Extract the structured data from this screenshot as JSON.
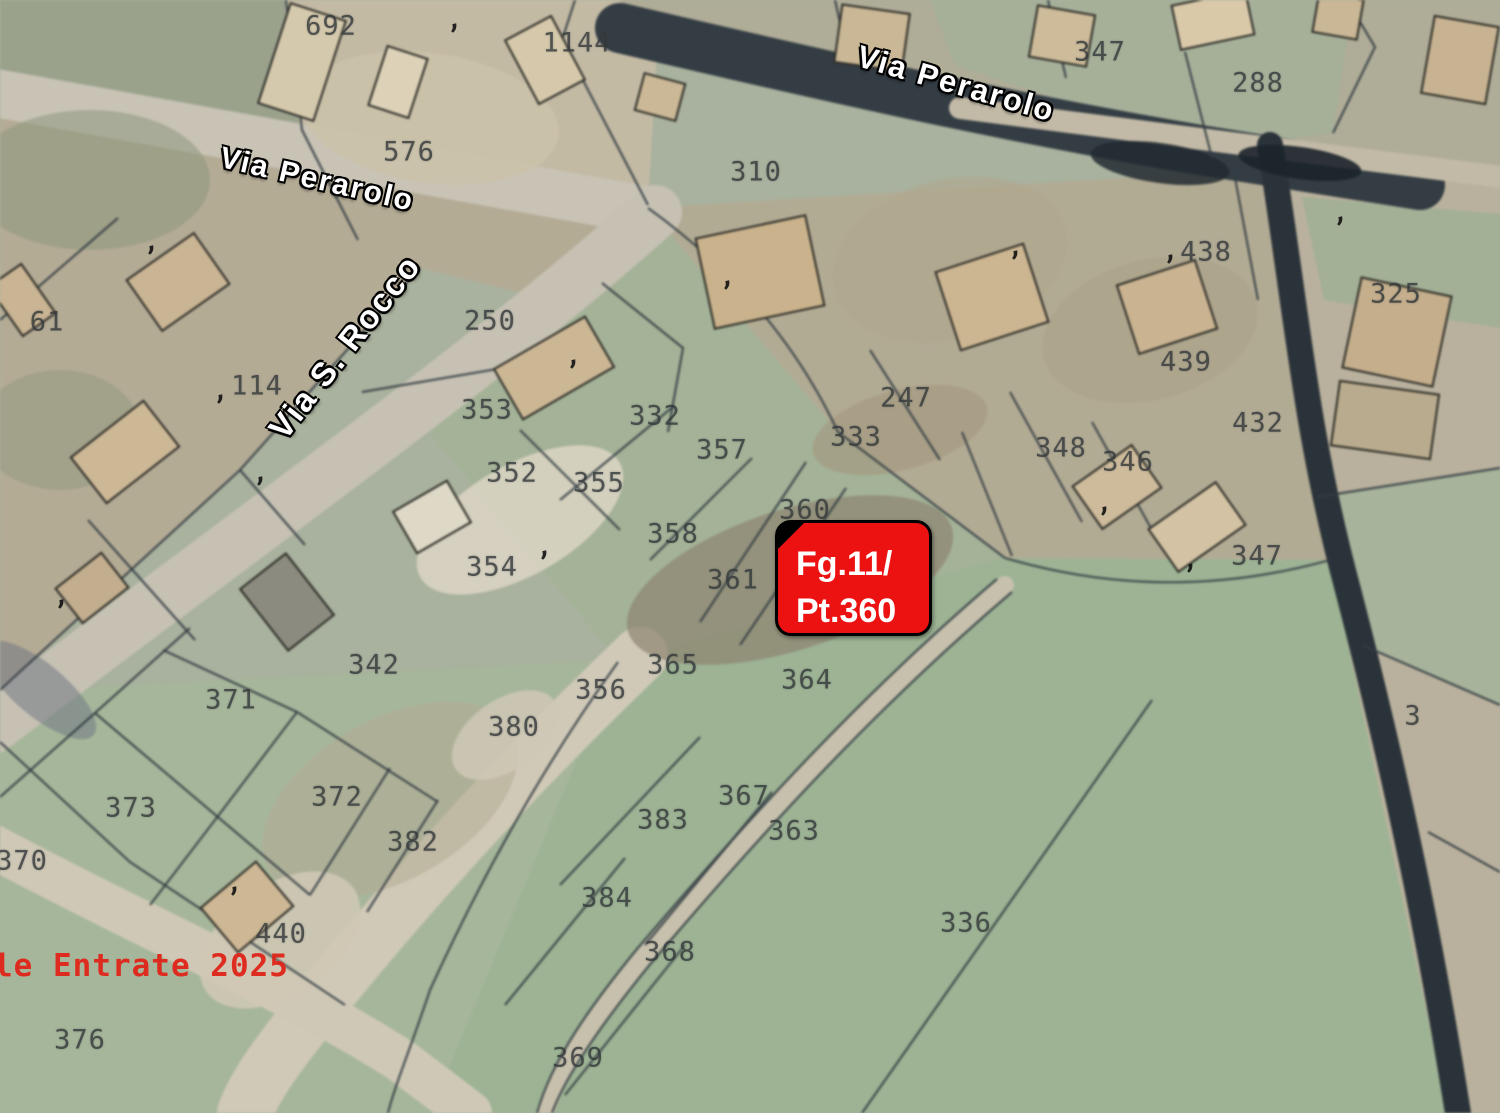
{
  "map": {
    "background_color": "#a9b29e",
    "boundary_color": "#333c43",
    "building_outline_color": "#2e2e28",
    "parcel_number_color": "#33383a",
    "street_label_color": "#ffffff",
    "annotation_box": {
      "line1": "Fg.11/",
      "line2": "Pt.360",
      "x": 775,
      "y": 520,
      "width": 157,
      "height": 116,
      "fill": "#ec1212",
      "border_color": "#000000",
      "text_color": "#ffffff",
      "font_size": 34
    },
    "attribution": {
      "text": "le Entrate 2025",
      "x": -6,
      "y": 966,
      "color": "#e0241a",
      "font_size": 31
    },
    "street_labels": [
      {
        "text": "Via Perarolo",
        "x": 317,
        "y": 180,
        "rotation": 13,
        "size": 30
      },
      {
        "text": "Via Perarolo",
        "x": 956,
        "y": 84,
        "rotation": 16,
        "size": 31
      },
      {
        "text": "Via S. Rocco",
        "x": 345,
        "y": 347,
        "rotation": -52,
        "size": 33
      }
    ],
    "parcel_labels": [
      {
        "t": "692",
        "x": 331,
        "y": 26
      },
      {
        "t": "1144",
        "x": 577,
        "y": 43
      },
      {
        "t": "347",
        "x": 1100,
        "y": 52
      },
      {
        "t": "288",
        "x": 1258,
        "y": 83
      },
      {
        "t": "576",
        "x": 409,
        "y": 152
      },
      {
        "t": "310",
        "x": 756,
        "y": 172
      },
      {
        "t": "438",
        "x": 1206,
        "y": 252
      },
      {
        "t": "325",
        "x": 1396,
        "y": 294
      },
      {
        "t": "61",
        "x": 47,
        "y": 322
      },
      {
        "t": "250",
        "x": 490,
        "y": 321
      },
      {
        "t": "439",
        "x": 1186,
        "y": 362
      },
      {
        "t": "114",
        "x": 257,
        "y": 386
      },
      {
        "t": "247",
        "x": 906,
        "y": 398
      },
      {
        "t": "353",
        "x": 487,
        "y": 410
      },
      {
        "t": "332",
        "x": 655,
        "y": 416
      },
      {
        "t": "432",
        "x": 1258,
        "y": 423
      },
      {
        "t": "333",
        "x": 856,
        "y": 437
      },
      {
        "t": "348",
        "x": 1061,
        "y": 448
      },
      {
        "t": "357",
        "x": 722,
        "y": 450
      },
      {
        "t": "346",
        "x": 1128,
        "y": 462
      },
      {
        "t": "352",
        "x": 512,
        "y": 473
      },
      {
        "t": "355",
        "x": 599,
        "y": 483
      },
      {
        "t": "360",
        "x": 805,
        "y": 510
      },
      {
        "t": "358",
        "x": 673,
        "y": 534
      },
      {
        "t": "347",
        "x": 1257,
        "y": 556
      },
      {
        "t": "354",
        "x": 492,
        "y": 567
      },
      {
        "t": "361",
        "x": 733,
        "y": 580
      },
      {
        "t": "342",
        "x": 374,
        "y": 665
      },
      {
        "t": "365",
        "x": 673,
        "y": 665
      },
      {
        "t": "364",
        "x": 807,
        "y": 680
      },
      {
        "t": "356",
        "x": 601,
        "y": 690
      },
      {
        "t": "371",
        "x": 231,
        "y": 700
      },
      {
        "t": "3",
        "x": 1413,
        "y": 716
      },
      {
        "t": "380",
        "x": 514,
        "y": 727
      },
      {
        "t": "367",
        "x": 744,
        "y": 796
      },
      {
        "t": "372",
        "x": 337,
        "y": 797
      },
      {
        "t": "373",
        "x": 131,
        "y": 808
      },
      {
        "t": "383",
        "x": 663,
        "y": 820
      },
      {
        "t": "363",
        "x": 794,
        "y": 831
      },
      {
        "t": "382",
        "x": 413,
        "y": 842
      },
      {
        "t": "370",
        "x": 22,
        "y": 861
      },
      {
        "t": "384",
        "x": 607,
        "y": 898
      },
      {
        "t": "336",
        "x": 966,
        "y": 923
      },
      {
        "t": "440",
        "x": 281,
        "y": 934
      },
      {
        "t": "368",
        "x": 670,
        "y": 952
      },
      {
        "t": "376",
        "x": 80,
        "y": 1040
      },
      {
        "t": "369",
        "x": 578,
        "y": 1058
      }
    ],
    "building_marks": [
      {
        "x": 456,
        "y": 36
      },
      {
        "x": 153,
        "y": 258
      },
      {
        "x": 729,
        "y": 293
      },
      {
        "x": 1017,
        "y": 263
      },
      {
        "x": 1172,
        "y": 267
      },
      {
        "x": 1342,
        "y": 229
      },
      {
        "x": 222,
        "y": 407
      },
      {
        "x": 575,
        "y": 372
      },
      {
        "x": 262,
        "y": 489
      },
      {
        "x": 1106,
        "y": 519
      },
      {
        "x": 1192,
        "y": 576
      },
      {
        "x": 546,
        "y": 563
      },
      {
        "x": 63,
        "y": 612
      },
      {
        "x": 236,
        "y": 899
      }
    ]
  },
  "geometry": {
    "fields": [
      {
        "p": "0,0 285,0 300,130 358,240 0,108",
        "f": "#9aa28c"
      },
      {
        "p": "285,0 660,0 648,205 358,240 300,130",
        "f": "#c3baa4"
      },
      {
        "p": "620,0 1500,0 1500,180 1420,185 640,36",
        "f": "#afac97"
      },
      {
        "p": "930,0 1353,0 1333,133 1210,150 955,65",
        "f": "#a6b099"
      },
      {
        "p": "1285,165 1500,185 1500,1113 1448,1113 1330,560",
        "f": "#b9b19d"
      },
      {
        "p": "1302,197 1500,214 1500,328 1324,300",
        "f": "#a3b096"
      },
      {
        "p": "1317,497 1500,468 1500,705 1362,645",
        "f": "#a7b39a"
      },
      {
        "p": "0,108 640,214 560,302 420,268 240,470 0,692",
        "f": "#b4ab95"
      },
      {
        "p": "648,208 1285,168 1330,560 1005,558 838,432",
        "f": "#b2ab94"
      },
      {
        "p": "648,208 838,432 1005,558 618,660 428,430",
        "f": "#a4b297"
      },
      {
        "p": "1005,558 1330,560 1448,1113 430,1113 618,660",
        "f": "#9db394"
      },
      {
        "p": "0,692 618,660 430,1113 0,1113",
        "f": "#a6b69a"
      }
    ],
    "patches": [
      {
        "x": 90,
        "y": 180,
        "rx": 120,
        "ry": 70,
        "rot": 0,
        "f": "#8e987e",
        "o": 0.55
      },
      {
        "x": 60,
        "y": 430,
        "rx": 80,
        "ry": 60,
        "rot": 0,
        "f": "#90987f",
        "o": 0.5
      },
      {
        "x": 430,
        "y": 118,
        "rx": 130,
        "ry": 65,
        "rot": 8,
        "f": "#cbc2aa",
        "o": 0.9
      },
      {
        "x": 950,
        "y": 260,
        "rx": 120,
        "ry": 80,
        "rot": -15,
        "f": "#b0a78e",
        "o": 0.6
      },
      {
        "x": 1150,
        "y": 330,
        "rx": 110,
        "ry": 70,
        "rot": -15,
        "f": "#aca289",
        "o": 0.6
      },
      {
        "x": 900,
        "y": 430,
        "rx": 90,
        "ry": 40,
        "rot": -15,
        "f": "#a3987e",
        "o": 0.6
      },
      {
        "x": 790,
        "y": 580,
        "rx": 170,
        "ry": 70,
        "rot": -18,
        "f": "#8d8570",
        "o": 0.7
      },
      {
        "x": 520,
        "y": 520,
        "rx": 115,
        "ry": 55,
        "rot": -30,
        "f": "#d9d3c2",
        "o": 0.9
      },
      {
        "x": 390,
        "y": 800,
        "rx": 140,
        "ry": 80,
        "rot": -30,
        "f": "#b3ab95",
        "o": 0.55
      },
      {
        "x": 505,
        "y": 735,
        "rx": 60,
        "ry": 35,
        "rot": -35,
        "f": "#cfc8b6",
        "o": 0.85
      },
      {
        "x": 280,
        "y": 940,
        "rx": 90,
        "ry": 55,
        "rot": -35,
        "f": "#cfc8b5",
        "o": 0.9
      },
      {
        "x": 40,
        "y": 690,
        "rx": 70,
        "ry": 26,
        "rot": 40,
        "f": "#6a7280",
        "o": 0.5
      },
      {
        "x": 1160,
        "y": 163,
        "rx": 70,
        "ry": 20,
        "rot": 8,
        "f": "#222a31",
        "o": 0.85
      },
      {
        "x": 1300,
        "y": 163,
        "rx": 62,
        "ry": 16,
        "rot": 8,
        "f": "#1c242b",
        "o": 0.9
      }
    ],
    "roads": [
      {
        "d": "M-10,92 C200,130 450,175 655,212",
        "c": "#c8c3b5",
        "w": 48
      },
      {
        "d": "M655,212 C520,335 320,480 120,630 C60,675 -5,725 -10,728",
        "c": "#c6c1b3",
        "w": 54
      },
      {
        "d": "M640,655 C520,770 420,880 330,990 C280,1050 255,1085 245,1113",
        "c": "#d0c9b7",
        "w": 56
      },
      {
        "d": "M-10,845 C140,925 300,995 400,1060 C440,1090 460,1105 470,1113",
        "c": "#cfc8b6",
        "w": 44
      },
      {
        "d": "M1005,585 C870,700 760,820 645,955 C600,1010 560,1065 545,1113",
        "c": "#c7c0ac",
        "w": 18
      },
      {
        "d": "M620,28 C820,75 1010,118 1200,150 C1300,166 1380,178 1420,185",
        "c": "#343d44",
        "w": 50
      },
      {
        "d": "M960,108 C1150,132 1320,155 1510,178",
        "c": "#c2baa6",
        "w": 22
      },
      {
        "d": "M1270,145 C1298,320 1305,430 1348,590 C1400,790 1432,950 1458,1113",
        "c": "#2b333a",
        "w": 26
      }
    ],
    "boundaries": [
      "M286,0 L302,130 L358,240",
      "M575,0 L562,40 L648,205",
      "M835,0 L848,58",
      "M1048,0 L1066,78",
      "M1185,52 L1212,158",
      "M1347,0 L1375,47 L1333,133",
      "M648,208 C720,260 790,330 838,432",
      "M838,432 L1005,558",
      "M1005,558 C1130,595 1240,585 1330,560",
      "M420,268 L240,470 L0,690",
      "M118,218 L0,320",
      "M240,470 L305,545",
      "M88,520 L195,640",
      "M0,742 L130,862 L345,1005",
      "M597,352 L362,392",
      "M674,406 L560,500",
      "M752,458 L650,560",
      "M806,462 L700,622",
      "M846,488 L740,645",
      "M602,283 L683,348 L668,432",
      "M520,430 L620,530",
      "M1152,700 L862,1113",
      "M618,662 C540,770 480,880 430,990 C410,1050 395,1085 388,1113",
      "M700,737 L560,885",
      "M772,792 L645,945",
      "M625,858 L505,1005",
      "M685,945 L565,1095",
      "M95,713 L310,895",
      "M190,628 L95,713 L0,797",
      "M297,712 L215,820 L150,905",
      "M390,768 L310,895",
      "M438,800 L367,912",
      "M163,650 L297,712 L438,802",
      "M1010,392 L1082,522",
      "M1092,422 L1162,548",
      "M962,432 L1012,556",
      "M1317,497 L1500,468",
      "M1362,645 L1500,705",
      "M1232,162 L1258,300",
      "M870,350 L940,460",
      "M1428,832 L1500,872",
      "M1012,592 C877,707 767,827 652,962 C607,1017 567,1072 552,1113",
      "M997,579 C862,694 752,814 637,949 C592,1004 552,1059 537,1113"
    ],
    "buildings": [
      {
        "x": 302,
        "y": 62,
        "w": 58,
        "h": 105,
        "r": 18,
        "f": "#d5c9ad"
      },
      {
        "x": 398,
        "y": 82,
        "w": 42,
        "h": 62,
        "r": 18,
        "f": "#ddd2b8"
      },
      {
        "x": 545,
        "y": 60,
        "w": 52,
        "h": 72,
        "r": -28,
        "f": "#d6c9ab"
      },
      {
        "x": 660,
        "y": 97,
        "w": 42,
        "h": 38,
        "r": 15,
        "f": "#cab896"
      },
      {
        "x": 872,
        "y": 38,
        "w": 68,
        "h": 58,
        "r": 8,
        "f": "#c9b795"
      },
      {
        "x": 1062,
        "y": 36,
        "w": 58,
        "h": 52,
        "r": 10,
        "f": "#cdbb9a"
      },
      {
        "x": 1213,
        "y": 20,
        "w": 75,
        "h": 45,
        "r": -12,
        "f": "#d9c9a9"
      },
      {
        "x": 1338,
        "y": 16,
        "w": 45,
        "h": 40,
        "r": 10,
        "f": "#c9b795"
      },
      {
        "x": 1460,
        "y": 60,
        "w": 65,
        "h": 78,
        "r": 10,
        "f": "#c7b392"
      },
      {
        "x": 178,
        "y": 282,
        "w": 82,
        "h": 62,
        "r": -35,
        "f": "#c9b493"
      },
      {
        "x": 22,
        "y": 300,
        "w": 40,
        "h": 60,
        "r": -35,
        "f": "#c9b493"
      },
      {
        "x": 125,
        "y": 452,
        "w": 92,
        "h": 58,
        "r": -38,
        "f": "#cdb896"
      },
      {
        "x": 92,
        "y": 588,
        "w": 58,
        "h": 44,
        "r": -38,
        "f": "#c2ae8e"
      },
      {
        "x": 554,
        "y": 368,
        "w": 105,
        "h": 58,
        "r": -30,
        "f": "#ccb795"
      },
      {
        "x": 760,
        "y": 272,
        "w": 112,
        "h": 92,
        "r": -12,
        "f": "#c9b28c"
      },
      {
        "x": 992,
        "y": 297,
        "w": 92,
        "h": 82,
        "r": -18,
        "f": "#ccb591"
      },
      {
        "x": 1167,
        "y": 307,
        "w": 82,
        "h": 72,
        "r": -18,
        "f": "#c9b391"
      },
      {
        "x": 1397,
        "y": 332,
        "w": 92,
        "h": 92,
        "r": 12,
        "f": "#c4ae8c"
      },
      {
        "x": 1117,
        "y": 487,
        "w": 72,
        "h": 52,
        "r": -35,
        "f": "#cebb9b"
      },
      {
        "x": 1197,
        "y": 527,
        "w": 82,
        "h": 52,
        "r": -35,
        "f": "#d3c3a4"
      },
      {
        "x": 1385,
        "y": 420,
        "w": 100,
        "h": 65,
        "r": 8,
        "f": "#b9ab8d"
      },
      {
        "x": 432,
        "y": 517,
        "w": 62,
        "h": 48,
        "r": -30,
        "f": "#ded8c6"
      },
      {
        "x": 287,
        "y": 602,
        "w": 58,
        "h": 78,
        "r": -38,
        "f": "#8b8b80"
      },
      {
        "x": 247,
        "y": 907,
        "w": 72,
        "h": 58,
        "r": -40,
        "f": "#cdb794"
      }
    ]
  }
}
